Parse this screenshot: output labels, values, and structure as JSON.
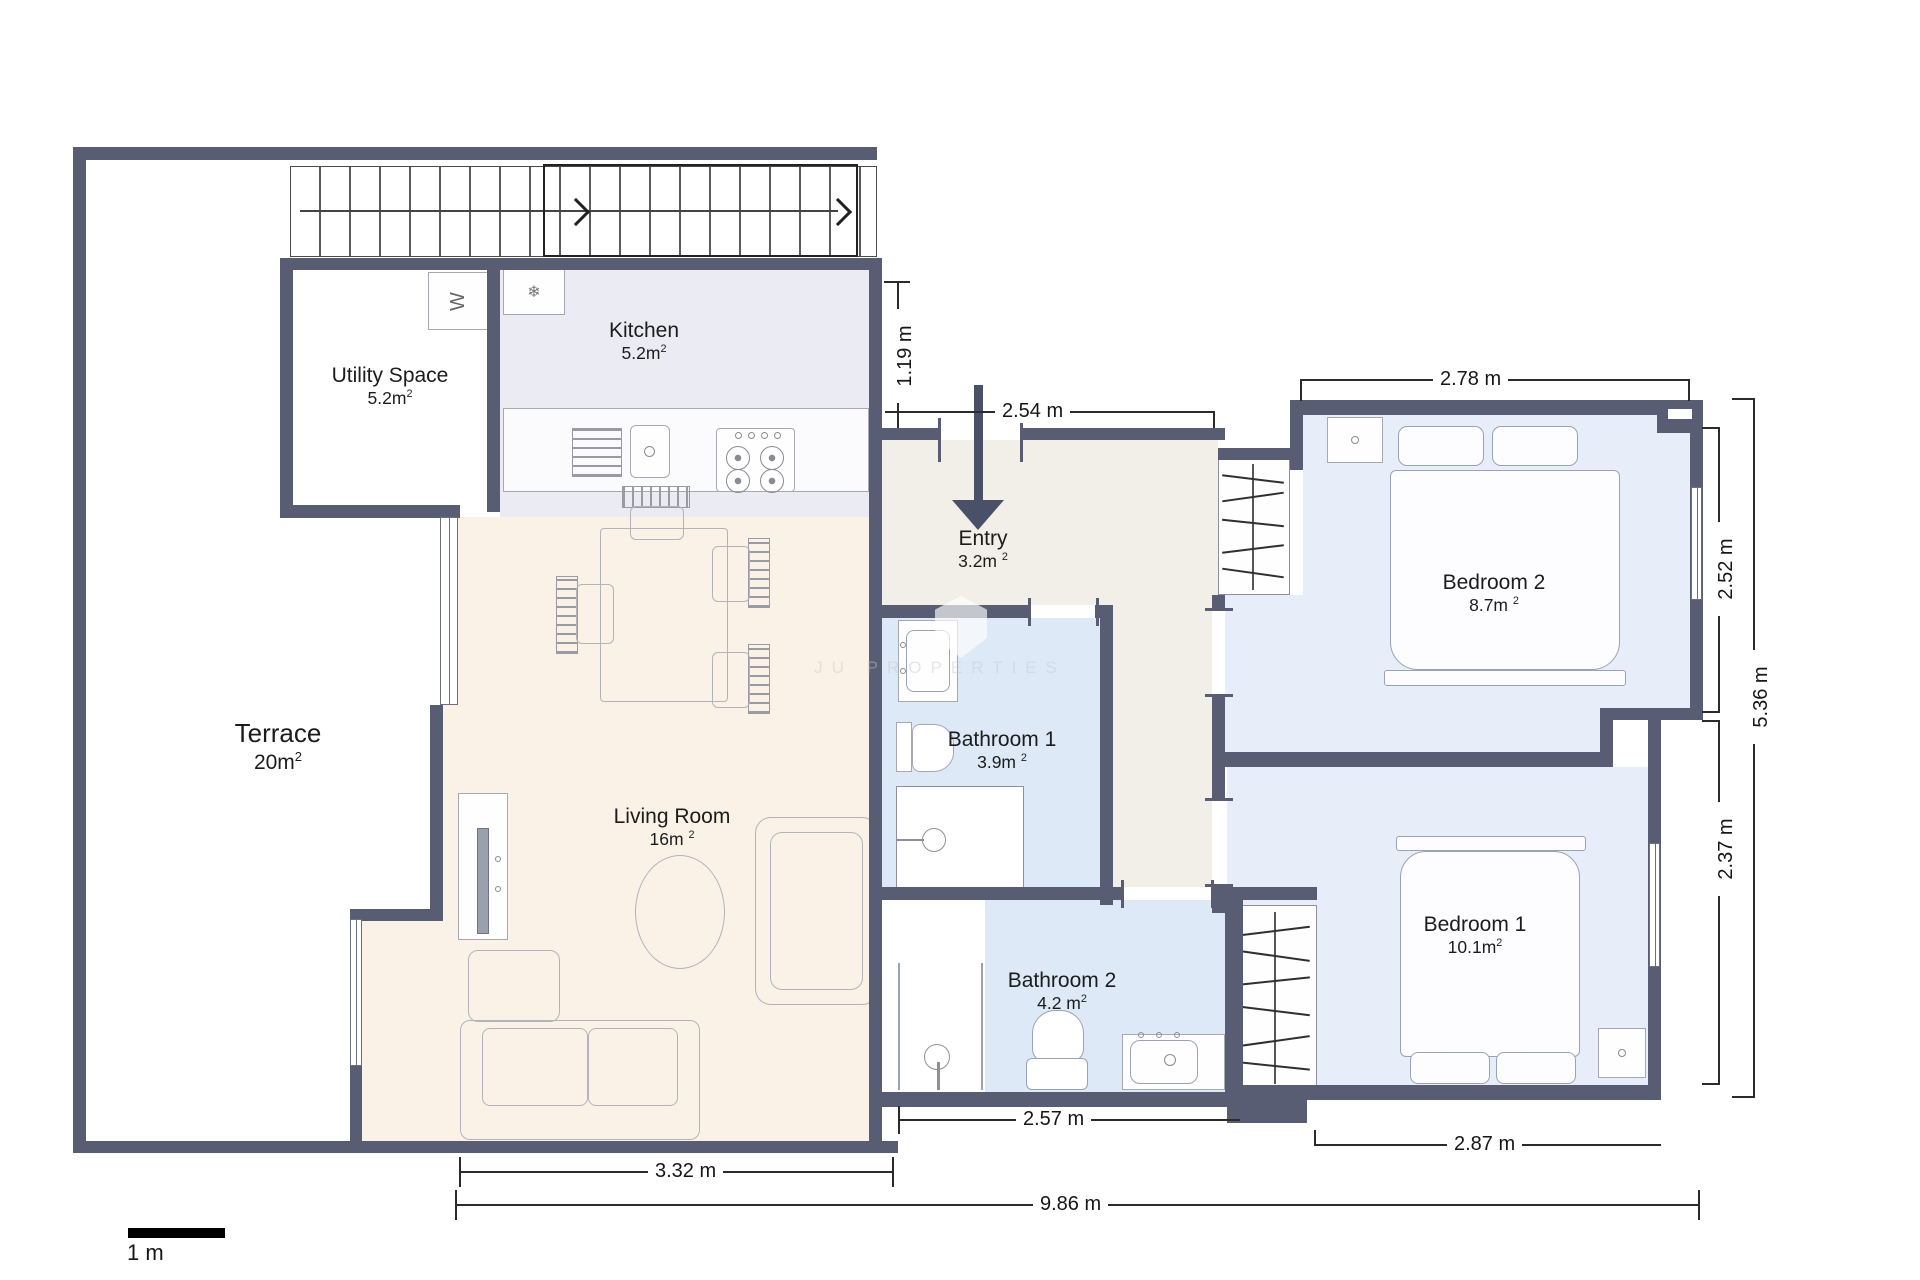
{
  "plan": {
    "sup": "2",
    "rooms": {
      "terrace": {
        "name": "Terrace",
        "area": "20m"
      },
      "utility": {
        "name": "Utility Space",
        "area": "5.2m"
      },
      "kitchen": {
        "name": "Kitchen",
        "area": "5.2m"
      },
      "entry": {
        "name": "Entry",
        "area": "3.2m"
      },
      "living": {
        "name": "Living Room",
        "area": "16m"
      },
      "bath1": {
        "name": "Bathroom 1",
        "area": "3.9m"
      },
      "bath2": {
        "name": "Bathroom 2",
        "area": "4.2 m"
      },
      "bed2": {
        "name": "Bedroom 2",
        "area": "8.7m"
      },
      "bed1": {
        "name": "Bedroom 1",
        "area": "10.1m"
      }
    },
    "dimensions": {
      "kitchen_wall": "1.19 m",
      "entry_width": "2.54 m",
      "bed2_width": "2.78 m",
      "bed2_height": "2.52 m",
      "right_height": "5.36 m",
      "bed1_height": "2.37 m",
      "bath2_width": "2.57 m",
      "bed1_width": "2.87 m",
      "living_width": "3.32 m",
      "total_width": "9.86 m"
    },
    "scale_label": "1 m",
    "icons": {
      "fridge": "❄",
      "washer": "W"
    },
    "watermark": "JU PROPERTIES",
    "colors": {
      "wall": "#585d74",
      "kitchen_floor": "#ebebf3",
      "living_floor": "#faf2e6",
      "entry_floor": "#f1efe8",
      "bath_floor": "#dde9f6",
      "bedroom_floor": "#e8eef9"
    }
  }
}
